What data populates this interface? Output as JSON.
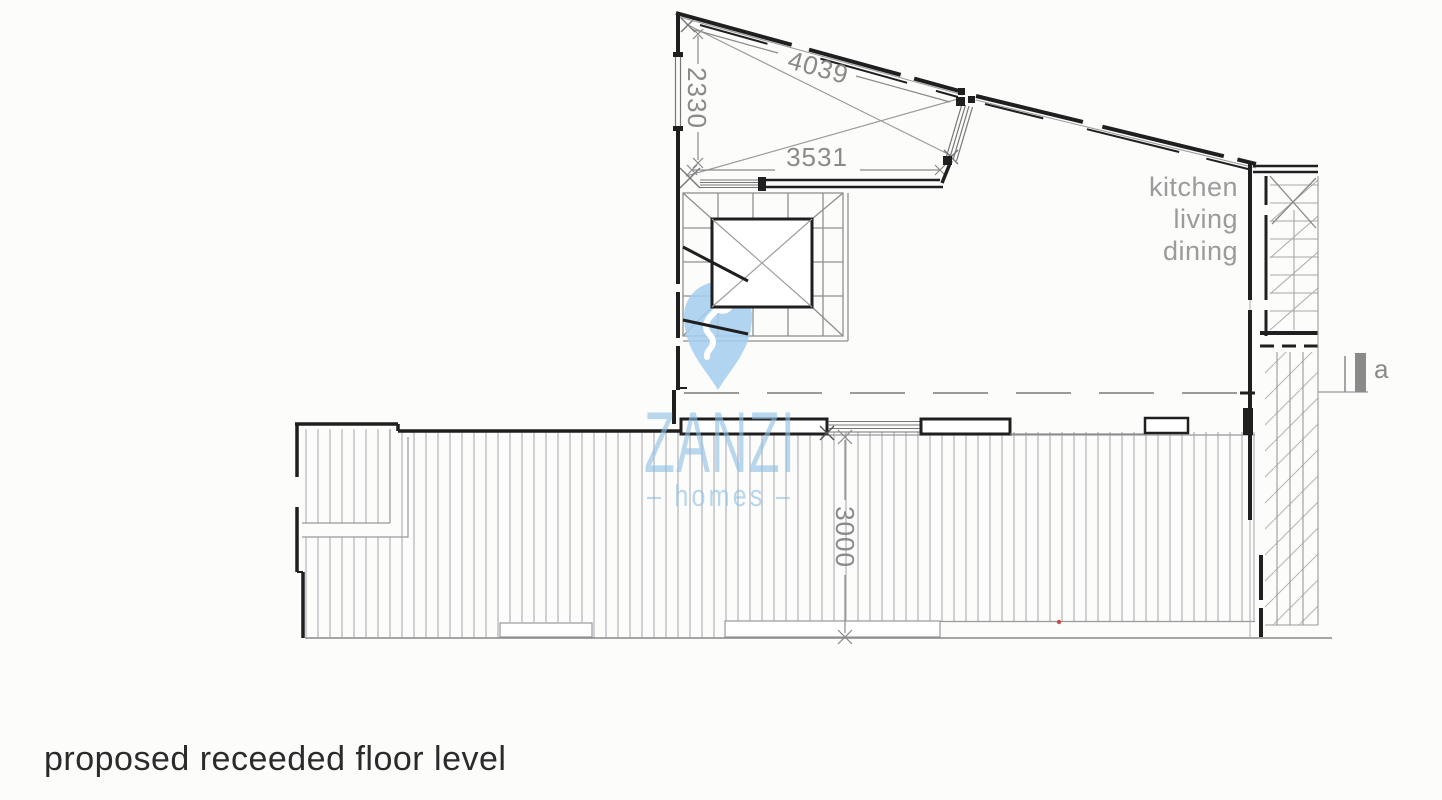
{
  "caption": {
    "text": "proposed receeded floor level"
  },
  "room_label": {
    "lines": [
      "kitchen",
      "living",
      "dining"
    ]
  },
  "dimensions": {
    "diagonal": "4039",
    "height": "2330",
    "width": "3531",
    "terrace_depth": "3000"
  },
  "section_marker": {
    "label": "a"
  },
  "watermark": {
    "brand": "ZANZI",
    "tagline": "– homes –"
  },
  "colors": {
    "wall_black": "#1f1f1f",
    "line_gray": "#8a8a8a",
    "deck_line": "#b3b3b9",
    "watermark_blue": "#8fc1e6",
    "red_dot": "#c0392b"
  }
}
